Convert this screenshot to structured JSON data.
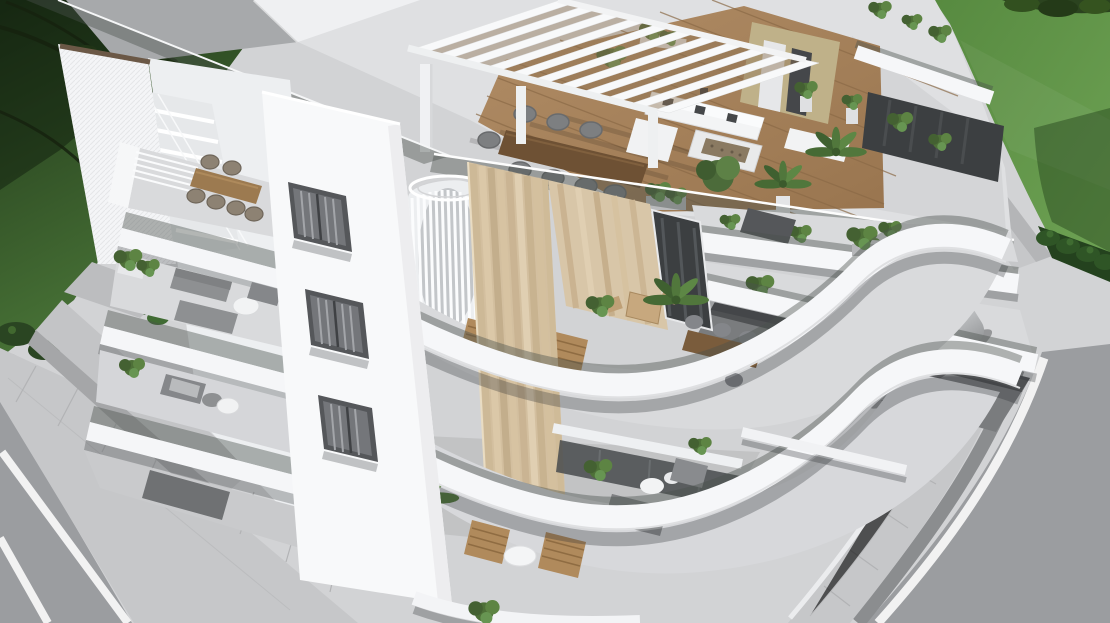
{
  "scene": {
    "type": "3d-architectural-render",
    "description": "Aerial 3D rendering of a modern white three-storey apartment building with sweeping curved balconies, a rooftop pergola terrace, landscaped lawns, surrounding streets and a silver car parked beneath the cantilevered balcony",
    "building": {
      "storeys_visible": 3,
      "features": [
        "rooftop terrace with white slatted pergola",
        "wooden roof deck with white lounge sofas and fire-pit table",
        "outdoor dining table with grey chairs",
        "curved white balcony bands with glass railings",
        "travertine stone feature wall",
        "white spiral staircase enclosure",
        "perforated white corner screen with external stair",
        "recessed windows with vertical blinds",
        "balconies furnished with sofas, timber chairs, bistro sets and planters"
      ]
    },
    "environment": {
      "top_left": "shaded dark lawn with overhanging tree branches and low bushes",
      "top_right": "sunlit lawn with tree canopy, hedge row and concrete ramp wall",
      "left_foreground": "asphalt street with white road markings and paved sidewalk",
      "right_foreground": "curved asphalt street with white edge line, gutter and paved sidewalk",
      "vehicle": "silver sedan parked on the driveway under the building"
    },
    "palette": {
      "concrete": "#d2d3d5",
      "paver": "#c6c7c9",
      "asphalt": "#9b9da0",
      "road_line": "#f2f2f2",
      "grass_dark": "#2c4a28",
      "grass_bright": "#64964a",
      "foliage": "#22351a",
      "hedge": "#2f5526",
      "building_white": "#f6f7f9",
      "slab_edge": "#ffffff",
      "floor_gray": "#d9dadc",
      "wood_deck": "#a8835c",
      "wood_dark": "#6e5134",
      "travertine": "#d3bf9f",
      "window_dark": "#55575a",
      "glazing": "#3c3f41",
      "sofa_gray": "#8e9092",
      "car_silver": "#b6b8ba",
      "plant_green": "#4e7038",
      "glass_tint": "#49524d",
      "shadow": "#2c3032"
    }
  }
}
